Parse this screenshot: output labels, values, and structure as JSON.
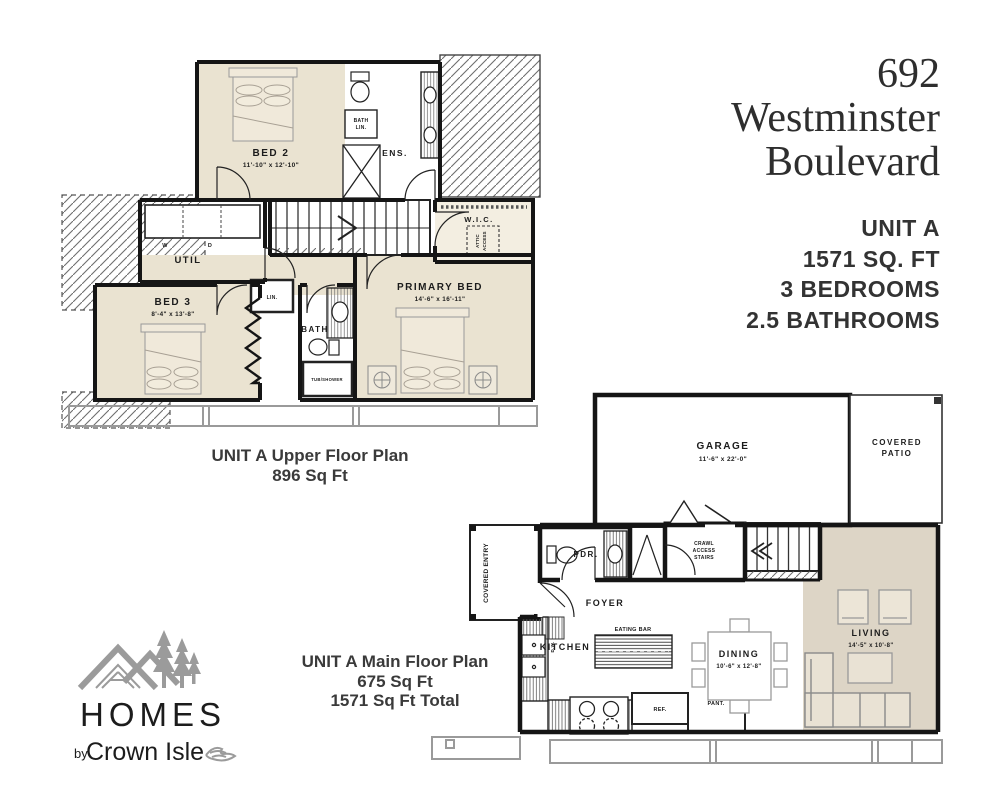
{
  "title_block": {
    "number": "692",
    "street_line1": "Westminster",
    "street_line2": "Boulevard",
    "unit": "UNIT A",
    "area": "1571 SQ. FT",
    "bedrooms": "3 BEDROOMS",
    "bathrooms": "2.5 BATHROOMS"
  },
  "upper_floor": {
    "caption_line1": "UNIT A Upper Floor Plan",
    "caption_line2": "896 Sq Ft",
    "labels": {
      "bed2": {
        "name": "BED 2",
        "dim": "11'-10\" x 12'-10\""
      },
      "ens": {
        "name": "ENS."
      },
      "bath_lin": {
        "line1": "BATH",
        "line2": "LIN."
      },
      "util": {
        "name": "UTIL"
      },
      "washer": "W",
      "dryer": "D",
      "wic": {
        "name": "W.I.C."
      },
      "attic": {
        "line1": "ATTIC",
        "line2": "ACCESS"
      },
      "bed3": {
        "name": "BED 3",
        "dim": "8'-4\" x 13'-8\""
      },
      "lin": {
        "name": "LIN."
      },
      "bath": {
        "name": "BATH"
      },
      "tub": {
        "name": "TUB/SHOWER"
      },
      "primary": {
        "name": "PRIMARY BED",
        "dim": "14'-6\" x 16'-11\""
      }
    }
  },
  "main_floor": {
    "caption_line1": "UNIT A Main Floor Plan",
    "caption_line2": "675 Sq Ft",
    "caption_line3": "1571 Sq Ft Total",
    "labels": {
      "garage": {
        "name": "GARAGE",
        "dim": "11'-6\" x 22'-0\""
      },
      "patio": {
        "line1": "COVERED",
        "line2": "PATIO"
      },
      "entry": {
        "name": "COVERED ENTRY"
      },
      "pdr": {
        "name": "PDR."
      },
      "foyer": {
        "name": "FOYER"
      },
      "crawl": {
        "line1": "CRAWL",
        "line2": "ACCESS",
        "line3": "STAIRS"
      },
      "kitchen": {
        "name": "KITCHEN"
      },
      "eating_bar": {
        "name": "EATING BAR"
      },
      "dw": {
        "name": "D.W."
      },
      "ref": {
        "name": "REF."
      },
      "pant": {
        "name": "PANT."
      },
      "dining": {
        "name": "DINING",
        "dim": "10'-6\" x 12'-8\""
      },
      "living": {
        "name": "LIVING",
        "dim": "14'-5\" x 10'-8\""
      }
    }
  },
  "logo": {
    "name": "HOMES",
    "byline_prefix": "by",
    "byline": "Crown Isle"
  },
  "colors": {
    "room_fill": "#eae3d1",
    "living_fill": "#ddd5c6",
    "wall": "#151515",
    "roof_line": "#9a9a9a",
    "logo_gray": "#9b9b9b",
    "text_dark": "#2e2e2e"
  }
}
